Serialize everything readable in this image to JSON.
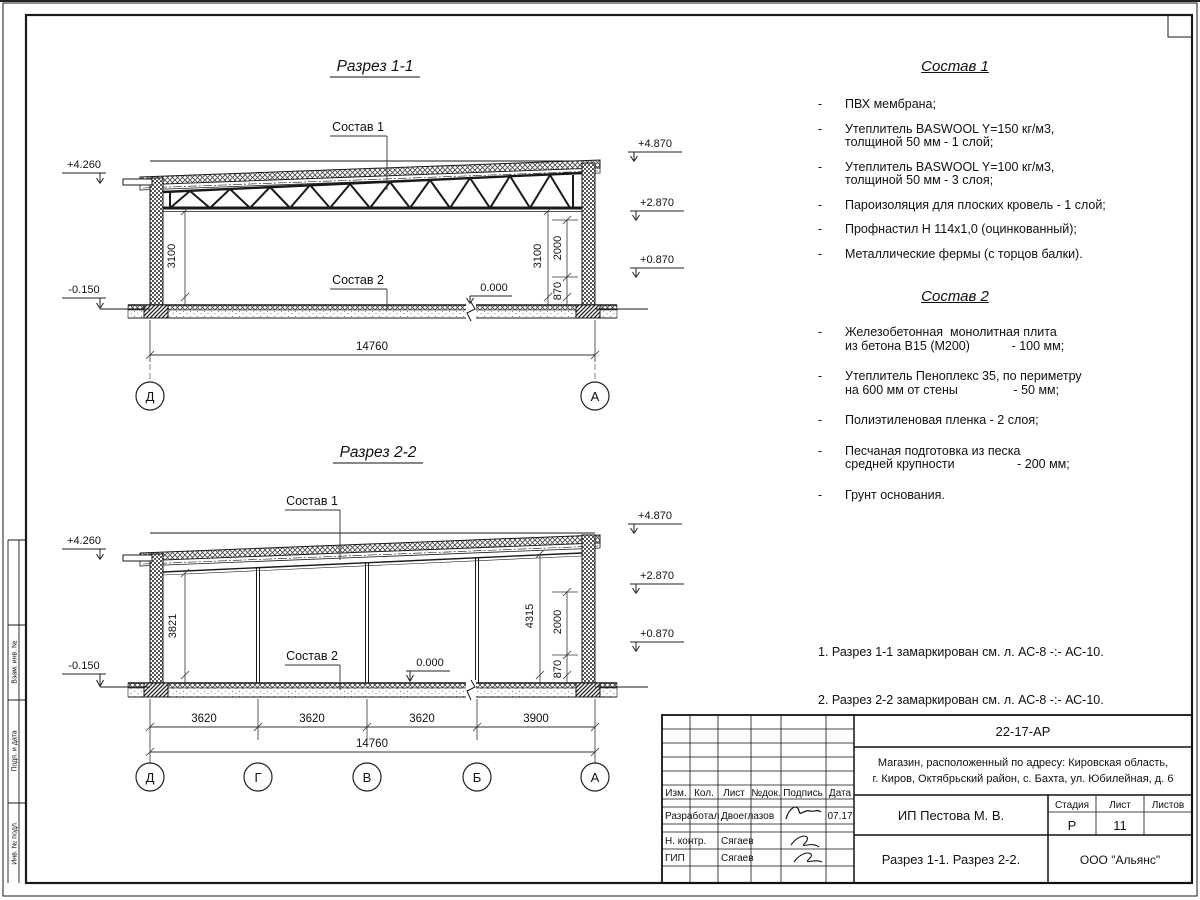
{
  "s1": {
    "title": "Разрез 1-1",
    "label_sostav1": "Состав 1",
    "label_sostav2": "Состав 2",
    "elev_l_top": "+4.260",
    "elev_l_bot": "-0.150",
    "elev_r1": "+4.870",
    "elev_r2": "+2.870",
    "elev_r3": "+0.870",
    "zero": "0.000",
    "dim_h_l": "3100",
    "dim_h_r": "3100",
    "dim_2000": "2000",
    "dim_870": "870",
    "dim_total": "14760",
    "axis_l": "Д",
    "axis_r": "А"
  },
  "s2": {
    "title": "Разрез 2-2",
    "label_sostav1": "Состав 1",
    "label_sostav2": "Состав 2",
    "elev_l_top": "+4.260",
    "elev_l_bot": "-0.150",
    "elev_r1": "+4.870",
    "elev_r2": "+2.870",
    "elev_r3": "+0.870",
    "zero": "0.000",
    "dim_h_l": "3821",
    "dim_h_r": "4315",
    "dim_2000": "2000",
    "dim_870": "870",
    "d1": "3620",
    "d2": "3620",
    "d3": "3620",
    "d4": "3900",
    "dim_total": "14760",
    "ax1": "Д",
    "ax2": "Г",
    "ax3": "В",
    "ax4": "Б",
    "ax5": "А"
  },
  "sostav1": {
    "title": "Состав 1",
    "dash": "-",
    "items": [
      {
        "line1": "ПВХ мембрана;",
        "line2": ""
      },
      {
        "line1": "Утеплитель BASWOOL Y=150 кг/м3,",
        "line2": "толщиной 50 мм - 1 слой;"
      },
      {
        "line1": "Утеплитель BASWOOL Y=100 кг/м3,",
        "line2": "толщиной 50 мм - 3 слоя;"
      },
      {
        "line1": "Пароизоляция для плоских кровель - 1 слой;",
        "line2": ""
      },
      {
        "line1": "Профнастил Н 114х1,0 (оцинкованный);",
        "line2": ""
      },
      {
        "line1": "Металлические фермы (с торцов балки).",
        "line2": ""
      }
    ]
  },
  "sostav2": {
    "title": "Состав 2",
    "dash": "-",
    "items": [
      {
        "line1": "Железобетонная  монолитная плита",
        "line2": "из бетона В15 (М200)            - 100 мм;"
      },
      {
        "line1": "Утеплитель Пеноплекс 35, по периметру",
        "line2": "на 600 мм от стены                - 50 мм;"
      },
      {
        "line1": "Полиэтиленовая пленка - 2 слоя;",
        "line2": ""
      },
      {
        "line1": "Песчаная подготовка из песка",
        "line2": "средней крупности                  - 200 мм;"
      },
      {
        "line1": "Грунт основания.",
        "line2": ""
      }
    ]
  },
  "notes": {
    "line1": "1. Разрез 1-1 замаркирован см. л. АС-8 -:- АС-10.",
    "line2": "2. Разрез 2-2 замаркирован см. л. АС-8 -:- АС-10."
  },
  "stamp": {
    "c1": "Взам. инв. №",
    "c2": "Подп. и дата",
    "c3": "Инв. № подл."
  },
  "titleblock": {
    "doc_code": "22-17-АР",
    "address_line1": "Магазин, расположенный по адресу: Кировская область,",
    "address_line2": "г. Киров, Октябрьский район, с. Бахта, ул. Юбилейная, д. 6",
    "col_izm": "Изм.",
    "col_kol": "Кол.",
    "col_list": "Лист",
    "col_ndok": "№док.",
    "col_podpis": "Подпись",
    "col_data": "Дата",
    "row1_role": "Разработал",
    "row1_name": "Двоеглазов",
    "row1_date": "07.17",
    "row2_role": "Н. контр.",
    "row2_name": "Сягаев",
    "row3_role": "ГИП",
    "row3_name": "Сягаев",
    "client": "ИП Пестова М. В.",
    "stage_label": "Стадия",
    "sheet_label": "Лист",
    "sheets_label": "Листов",
    "stage": "Р",
    "sheet": "11",
    "sheets": "",
    "sheet_title": "Разрез 1-1. Разрез 2-2.",
    "org": "ООО \"Альянс\""
  }
}
